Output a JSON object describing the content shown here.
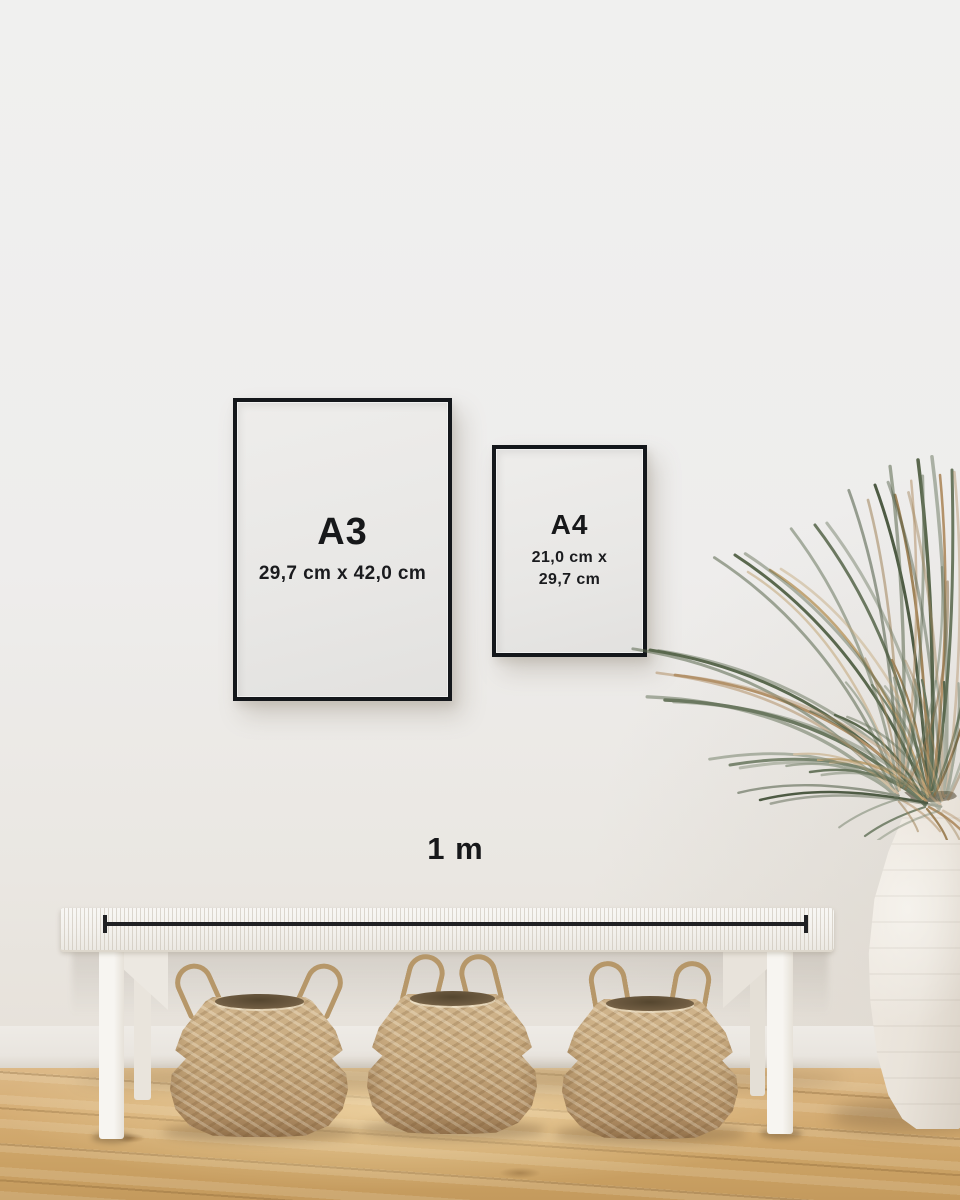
{
  "frames": [
    {
      "id": "a3",
      "label": "A3",
      "dimensions": "29,7 cm x 42,0 cm"
    },
    {
      "id": "a4",
      "label": "A4",
      "dimensions_line1": "21,0 cm x",
      "dimensions_line2": "29,7 cm"
    }
  ],
  "scale": {
    "label": "1 m"
  },
  "colors": {
    "wall": "#efefee",
    "frame_border": "#14171b",
    "paper": "#e8e7e5",
    "text": "#17181a",
    "scale_bar": "#202124",
    "bench": "#f4f2ee",
    "basket": "#c2a379",
    "basket_rope": "#b69769",
    "floor_wood": "#cda568",
    "vase": "#e9e3da",
    "plant_green": "#67755a",
    "plant_dried": "#b3926a"
  }
}
